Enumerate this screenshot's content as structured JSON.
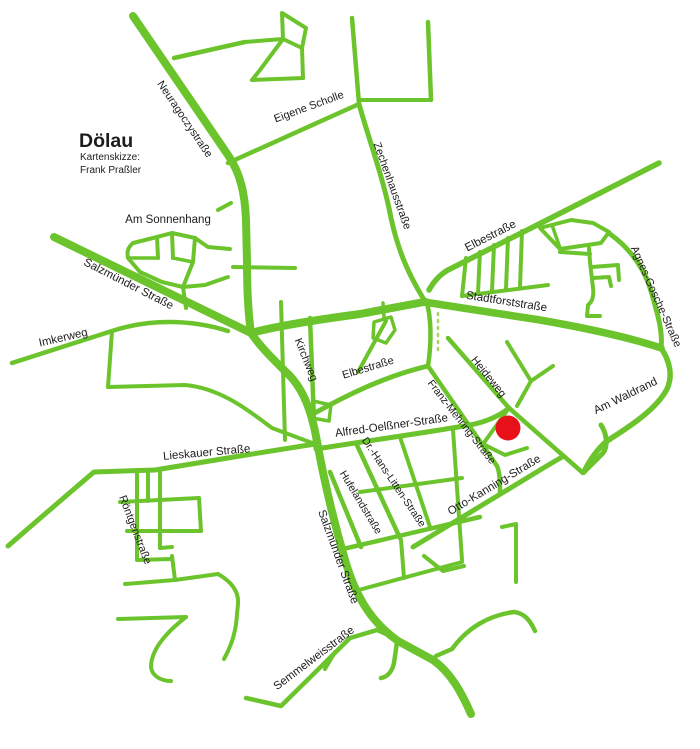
{
  "map": {
    "title": "Dölau",
    "subtitle_line1": "Kartenskizze:",
    "subtitle_line2": "Frank Praßler",
    "colors": {
      "background": "#ffffff",
      "road": "#6cc42c",
      "road_dotted": "#a9d45f",
      "label": "#1c1c1c",
      "marker": "#e8111a"
    },
    "marker": {
      "name": "highlighted-location",
      "x": 508,
      "y": 428,
      "r": 12.5
    },
    "labels": [
      {
        "id": "title",
        "text": "Dölau",
        "x": 79,
        "y": 147,
        "size": 19.5,
        "rotate": 0,
        "anchor": "start",
        "weight": "bold"
      },
      {
        "id": "subtitle-1",
        "text": "Kartenskizze:",
        "x": 80,
        "y": 160,
        "size": 10,
        "rotate": 0,
        "anchor": "start",
        "weight": "normal"
      },
      {
        "id": "subtitle-2",
        "text": "Frank Praßler",
        "x": 80,
        "y": 173,
        "size": 10,
        "rotate": 0,
        "anchor": "start",
        "weight": "normal"
      },
      {
        "id": "neuragoczystrasse",
        "text": "Neuragoczystraße",
        "x": 182,
        "y": 121,
        "size": 11,
        "rotate": 56
      },
      {
        "id": "eigene-scholle",
        "text": "Eigene Scholle",
        "x": 310,
        "y": 110,
        "size": 11,
        "rotate": -20
      },
      {
        "id": "zechenhausstrasse",
        "text": "Zechenhausstraße",
        "x": 389,
        "y": 187,
        "size": 11,
        "rotate": 70
      },
      {
        "id": "am-sonnenhang",
        "text": "Am Sonnenhang",
        "x": 168,
        "y": 223,
        "size": 11.5,
        "rotate": 0
      },
      {
        "id": "elbestrasse-ne",
        "text": "Elbestraße",
        "x": 492,
        "y": 239,
        "size": 11.5,
        "rotate": -27
      },
      {
        "id": "agnes-gosche-strasse",
        "text": "Agnes-Gosche-Straße",
        "x": 653,
        "y": 298,
        "size": 11,
        "rotate": 66
      },
      {
        "id": "salzmuender-strasse-nw",
        "text": "Salzmünder Straße",
        "x": 127,
        "y": 287,
        "size": 11.5,
        "rotate": 27
      },
      {
        "id": "imkerweg",
        "text": "Imkerweg",
        "x": 64,
        "y": 341,
        "size": 11.5,
        "rotate": -13
      },
      {
        "id": "stadtforststrasse",
        "text": "Stadtforststraße",
        "x": 506,
        "y": 305,
        "size": 11.5,
        "rotate": 9
      },
      {
        "id": "kirchweg",
        "text": "Kirchweg",
        "x": 303,
        "y": 361,
        "size": 11,
        "rotate": 68
      },
      {
        "id": "elbestrasse-center",
        "text": "Elbestraße",
        "x": 369,
        "y": 371,
        "size": 11,
        "rotate": -17
      },
      {
        "id": "heideweg",
        "text": "Heideweg",
        "x": 486,
        "y": 379,
        "size": 11,
        "rotate": 51
      },
      {
        "id": "am-waldrand",
        "text": "Am Waldrand",
        "x": 627,
        "y": 399,
        "size": 11.5,
        "rotate": -26
      },
      {
        "id": "franz-mehring-strasse",
        "text": "Franz-Mehring-Straße",
        "x": 459,
        "y": 424,
        "size": 10.5,
        "rotate": 52
      },
      {
        "id": "alfred-oelssner-strasse",
        "text": "Alfred-Oelßner-Straße",
        "x": 392,
        "y": 429,
        "size": 11.5,
        "rotate": -8
      },
      {
        "id": "lieskauer-strasse",
        "text": "Lieskauer Straße",
        "x": 207,
        "y": 456,
        "size": 11.5,
        "rotate": -5
      },
      {
        "id": "dr-hans-litten-strasse",
        "text": "Dr.-Hans-Litten-Straße",
        "x": 391,
        "y": 484,
        "size": 10.5,
        "rotate": 56
      },
      {
        "id": "hufelandstrasse",
        "text": "Hufelandstraße",
        "x": 358,
        "y": 504,
        "size": 10.5,
        "rotate": 59
      },
      {
        "id": "otto-kanning-strasse",
        "text": "Otto-Kanning-Straße",
        "x": 496,
        "y": 488,
        "size": 11.5,
        "rotate": -31
      },
      {
        "id": "roentgenstrasse",
        "text": "Röntgenstraße",
        "x": 132,
        "y": 531,
        "size": 11,
        "rotate": 69
      },
      {
        "id": "salzmuender-strasse-s",
        "text": "Salzmünder Straße",
        "x": 335,
        "y": 558,
        "size": 11.5,
        "rotate": 70
      },
      {
        "id": "semmelweisstrasse",
        "text": "Semmelweisstraße",
        "x": 316,
        "y": 661,
        "size": 11.5,
        "rotate": -37
      }
    ],
    "roads": [
      {
        "id": "neuragoczystrasse",
        "d": "M133,16 L228,155 C241,174 245,195 246,220 L247,262 C247,288 248,312 251,333",
        "w": 8
      },
      {
        "id": "salzmuender-upper",
        "d": "M54,237 L251,333",
        "w": 8
      },
      {
        "id": "salzmuender-main",
        "d": "M251,333 C262,349 276,362 290,376 C304,391 311,411 316,436 C322,470 331,512 345,560 C357,601 374,624 398,641 L433,660 C450,672 461,691 471,714",
        "w": 8
      },
      {
        "id": "stadtforst-west",
        "d": "M251,333 C280,325 330,318 360,314 L424,302",
        "w": 8
      },
      {
        "id": "stadtforststrasse",
        "d": "M424,302 L540,320 C580,327 625,336 661,348",
        "w": 7.5
      },
      {
        "id": "elbestrasse-ne",
        "d": "M659,163 L545,221 L448,270 C441,274 434,281 429,290",
        "w": 5.5
      },
      {
        "id": "am-waldrand",
        "d": "M661,348 C670,361 673,376 667,389 C657,408 634,424 607,441 C598,448 589,461 584,472",
        "w": 5.5
      },
      {
        "id": "am-waldrand-hook",
        "d": "M584,472 L603,453 C608,446 607,434 601,425",
        "w": 5
      },
      {
        "id": "agnes-gosche",
        "d": "M610,234 C627,246 644,266 651,291 C658,315 663,332 661,348",
        "w": 5
      },
      {
        "id": "zechenhausstrasse",
        "d": "M359,104 C369,140 384,180 391,218 C399,255 411,278 423,298",
        "w": 5
      },
      {
        "id": "eigene-scholle",
        "d": "M228,163 L359,104",
        "w": 4.5
      },
      {
        "id": "top-v1",
        "d": "M352,18 L359,104",
        "w": 4.5
      },
      {
        "id": "top-v2",
        "d": "M428,22 L431,100",
        "w": 4.5
      },
      {
        "id": "top-h3",
        "d": "M359,100 C385,100 408,100 431,100",
        "w": 4
      },
      {
        "id": "top-branch1",
        "d": "M174,58 L245,42",
        "w": 4.5
      },
      {
        "id": "top-block",
        "d": "M282,13 L306,28 L302,48 L283,39 Z",
        "w": 4
      },
      {
        "id": "top-conn",
        "d": "M245,42 L283,39",
        "w": 4
      },
      {
        "id": "top-diag",
        "d": "M283,39 L260,70 L252,80",
        "w": 4
      },
      {
        "id": "top-h2",
        "d": "M252,80 L303,78",
        "w": 4
      },
      {
        "id": "top-vstem",
        "d": "M302,48 L303,78",
        "w": 4
      },
      {
        "id": "sonnenhang-top",
        "d": "M133,243 L157,237 L172,233 L195,238",
        "w": 4
      },
      {
        "id": "sonnenhang-diag",
        "d": "M195,238 L208,247 L230,249",
        "w": 4
      },
      {
        "id": "sonnenhang-left",
        "d": "M133,243 C127,248 127,253 128,258 L140,272",
        "w": 4
      },
      {
        "id": "sonnenhang-bottom",
        "d": "M140,272 L162,282 L183,287 L205,285 L228,277",
        "w": 4
      },
      {
        "id": "sonnenhang-v1",
        "d": "M157,237 L158,258",
        "w": 4
      },
      {
        "id": "sonnenhang-r1",
        "d": "M128,258 L158,258",
        "w": 3.5
      },
      {
        "id": "sonnenhang-v2",
        "d": "M172,233 L173,258",
        "w": 4
      },
      {
        "id": "sonnenhang-r2",
        "d": "M173,258 L193,262",
        "w": 3.5
      },
      {
        "id": "sonnenhang-v3",
        "d": "M195,238 L193,262 L183,287",
        "w": 4
      },
      {
        "id": "sonnenhang-spur",
        "d": "M183,287 L186,308",
        "w": 4
      },
      {
        "id": "sonnenhang-espur",
        "d": "M233,267 L295,268",
        "w": 4
      },
      {
        "id": "neurag-tick",
        "d": "M218,210 L231,203",
        "w": 4
      },
      {
        "id": "imkerweg",
        "d": "M12,363 L112,331 C148,319 190,319 228,331",
        "w": 4.5
      },
      {
        "id": "imker-branch",
        "d": "M112,331 L108,387",
        "w": 4
      },
      {
        "id": "sw-connector",
        "d": "M108,387 L185,385 C220,388 248,410 272,428 L315,444",
        "w": 4
      },
      {
        "id": "lieskauer",
        "d": "M8,546 C38,520 68,494 94,472 L155,470 L240,456 L315,444",
        "w": 5
      },
      {
        "id": "ladder-v1",
        "d": "M137,470 L137,560",
        "w": 4
      },
      {
        "id": "ladder-v2",
        "d": "M160,472 L160,548",
        "w": 4
      },
      {
        "id": "ladder-v3",
        "d": "M148,471 L148,501",
        "w": 4
      },
      {
        "id": "ladder-r1",
        "d": "M120,502 L199,498",
        "w": 4
      },
      {
        "id": "ladder-rv",
        "d": "M199,498 L201,531",
        "w": 4
      },
      {
        "id": "ladder-r2",
        "d": "M127,531 L201,531",
        "w": 4
      },
      {
        "id": "ladder-b",
        "d": "M137,560 L171,559",
        "w": 4
      },
      {
        "id": "ladder-b2",
        "d": "M160,548 L172,547",
        "w": 4
      },
      {
        "id": "kirchweg-road",
        "d": "M310,318 L315,446",
        "w": 4.5
      },
      {
        "id": "vert-west-kirchweg",
        "d": "M281,302 L285,440",
        "w": 4
      },
      {
        "id": "block-kirchweg",
        "d": "M313,401 L331,405 L329,421 L312,418 Z",
        "w": 3.5
      },
      {
        "id": "elbe-center",
        "d": "M313,414 C345,396 385,376 428,366",
        "w": 5
      },
      {
        "id": "elbe-north-conn",
        "d": "M428,366 C432,340 431,315 426,300",
        "w": 4.5
      },
      {
        "id": "stadtforst-elbe-conn",
        "d": "M358,372 L386,321",
        "w": 4
      },
      {
        "id": "block-pentagon",
        "d": "M374,322 L391,317 L395,330 L386,343 L373,338 Z",
        "w": 3.5
      },
      {
        "id": "pentagon-stem",
        "d": "M384,317 L383,303",
        "w": 3.5
      },
      {
        "id": "comb-h",
        "d": "M462,296 L548,285",
        "w": 4
      },
      {
        "id": "comb-t1",
        "d": "M466,258 L462,296",
        "w": 4
      },
      {
        "id": "comb-t2",
        "d": "M480,252 L478,293",
        "w": 4
      },
      {
        "id": "comb-t3",
        "d": "M494,245 L492,291",
        "w": 4
      },
      {
        "id": "comb-t4",
        "d": "M508,238 L506,289",
        "w": 4
      },
      {
        "id": "comb-t5",
        "d": "M522,231 L520,287",
        "w": 4
      },
      {
        "id": "pennant",
        "d": "M540,228 L571,220 L593,223 L609,232 L601,243 L560,249 Z",
        "w": 4
      },
      {
        "id": "pennant-inner",
        "d": "M552,225 L560,248",
        "w": 3.5
      },
      {
        "id": "pennant-stem",
        "d": "M589,248 L590,262",
        "w": 4
      },
      {
        "id": "pennant-h",
        "d": "M560,252 L590,254",
        "w": 4
      },
      {
        "id": "pennant-v2",
        "d": "M590,262 L593,288 C594,296 592,302 588,305 L587,316 L600,316",
        "w": 4
      },
      {
        "id": "pennant-b1",
        "d": "M592,267 L618,265 L619,280",
        "w": 4
      },
      {
        "id": "pennant-b2",
        "d": "M593,278 L609,277 L611,286",
        "w": 4
      },
      {
        "id": "dotted-path",
        "d": "M438,313 L438,353",
        "w": 2.5,
        "dash": "2 5",
        "color": "#a9d45f"
      },
      {
        "id": "heideweg-road",
        "d": "M448,338 L509,408",
        "w": 4.5
      },
      {
        "id": "checkmark",
        "d": "M507,342 L531,381 L553,366",
        "w": 4
      },
      {
        "id": "checkmark-stem",
        "d": "M531,381 L517,406",
        "w": 4
      },
      {
        "id": "junction-se",
        "d": "M509,408 L583,473",
        "w": 4.5
      },
      {
        "id": "dot-block-w",
        "d": "M509,408 L483,444",
        "w": 4
      },
      {
        "id": "dot-block-s",
        "d": "M483,444 L505,455 L527,448",
        "w": 4
      },
      {
        "id": "alfred-oelssner",
        "d": "M316,449 C360,442 430,432 470,425 C485,422 498,417 509,408",
        "w": 5
      },
      {
        "id": "franz-mehring",
        "d": "M428,366 L497,466 C500,473 500,482 500,492",
        "w": 4.5
      },
      {
        "id": "otto-kanning",
        "d": "M413,547 L545,467 L562,457",
        "w": 5
      },
      {
        "id": "grid-hufeland",
        "d": "M330,472 L361,547",
        "w": 4.5
      },
      {
        "id": "grid-litten",
        "d": "M356,443 L400,538",
        "w": 4.5
      },
      {
        "id": "grid-v3",
        "d": "M400,437 L430,527",
        "w": 4
      },
      {
        "id": "grid-v4",
        "d": "M453,430 L462,560",
        "w": 4
      },
      {
        "id": "grid-mid",
        "d": "M360,492 L462,478",
        "w": 4
      },
      {
        "id": "grid-bottom",
        "d": "M343,549 L480,517",
        "w": 4.5
      },
      {
        "id": "grid-lower",
        "d": "M355,591 L462,562",
        "w": 4
      },
      {
        "id": "grid-lower-v1",
        "d": "M401,540 L404,578",
        "w": 4
      },
      {
        "id": "u-shape",
        "d": "M502,527 L516,524 L516,582",
        "w": 4
      },
      {
        "id": "c-ne-branch",
        "d": "M424,556 L443,571 L464,566",
        "w": 4
      },
      {
        "id": "se-curve",
        "d": "M436,656 L452,649 C468,627 490,615 514,612 C524,613 530,620 535,631",
        "w": 4.5
      },
      {
        "id": "c-south-branch",
        "d": "M397,642 L394,663 C392,672 387,677 381,678",
        "w": 4.5
      },
      {
        "id": "semmelweis",
        "d": "M246,698 L281,706 L350,638 L377,630 L395,638",
        "w": 4.5
      },
      {
        "id": "semmel-spur",
        "d": "M325,669 L335,652",
        "w": 4
      },
      {
        "id": "bl-vert",
        "d": "M172,556 L175,580",
        "w": 4
      },
      {
        "id": "bl-horiz",
        "d": "M125,584 L175,580",
        "w": 4
      },
      {
        "id": "bl-conn",
        "d": "M175,580 L218,574",
        "w": 4
      },
      {
        "id": "bl-right",
        "d": "M218,574 C232,582 239,592 238,604 L237,614 C236,634 230,648 224,659",
        "w": 4
      },
      {
        "id": "bl-horiz2",
        "d": "M118,619 L186,617",
        "w": 4
      },
      {
        "id": "bl-hook",
        "d": "M186,617 C168,631 151,649 151,667 C152,676 161,681 171,681",
        "w": 4
      }
    ]
  }
}
